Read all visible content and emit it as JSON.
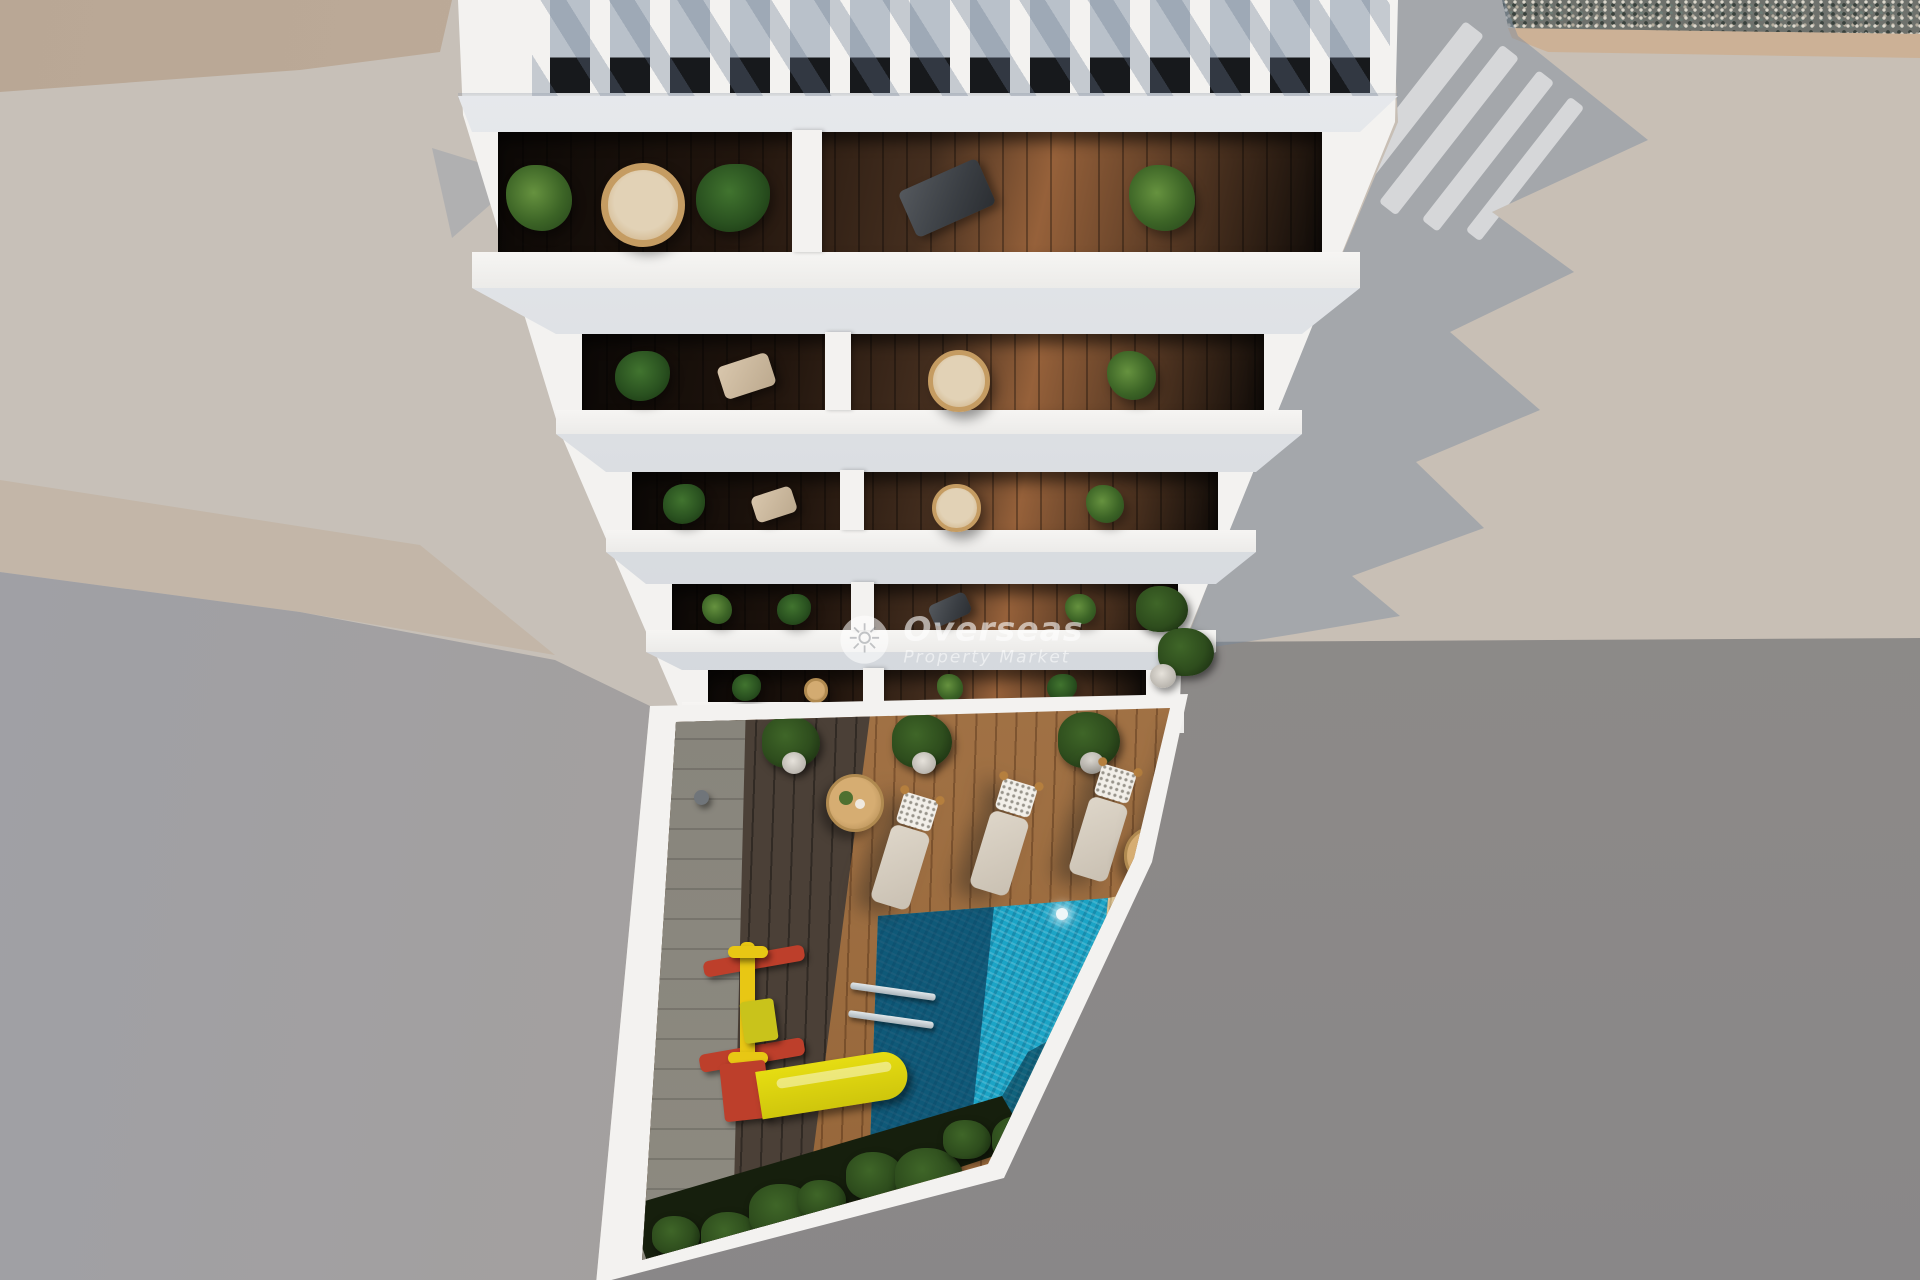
{
  "image": {
    "description": "Aerial top-down 3D architectural render of a white apartment building with rooftop pergola, five rows of stacked balconies and a courtyard with swimming pool, wooden deck, sun loungers and a children's playground",
    "width_px": 1920,
    "height_px": 1280
  },
  "watermark": {
    "brand": "Overseas",
    "tagline": "Property Market",
    "icon": "sun-icon"
  },
  "scene": {
    "building": {
      "label": "white apartment building seen from above",
      "pergola_gap_count": 14,
      "floors": [
        {
          "name": "floor-5",
          "left_unit": [
            "palm-plant",
            "hanging-chair",
            "monstera-plant"
          ],
          "right_unit": [
            "deck-chair",
            "palm-plant"
          ]
        },
        {
          "name": "floor-4",
          "left_unit": [
            "monstera-plant",
            "lounge-chair"
          ],
          "right_unit": [
            "hanging-chair",
            "palm-plant"
          ]
        },
        {
          "name": "floor-3",
          "left_unit": [
            "monstera-plant",
            "lounge-chair"
          ],
          "right_unit": [
            "hanging-chair",
            "palm-plant"
          ]
        },
        {
          "name": "floor-2",
          "left_unit": [
            "palm-plant",
            "monstera-plant"
          ],
          "right_unit": [
            "deck-chair",
            "palm-plant"
          ]
        },
        {
          "name": "floor-1",
          "left_unit": [
            "monstera-plant",
            "round-table"
          ],
          "right_unit": [
            "palm-plant",
            "monstera-plant"
          ]
        }
      ]
    },
    "courtyard": {
      "lounger_count": 4,
      "side_table_count": 2,
      "deck_pot_count": 3,
      "bottom_plant_cluster_count": 8,
      "features": [
        "swimming-pool",
        "pool-ladder",
        "pool-light",
        "wood-deck",
        "sun-loungers",
        "kids-swing-frame",
        "kids-slide",
        "potted-plants",
        "hedge-strip"
      ]
    },
    "surroundings": [
      "neighbor-flat-roof-left",
      "neighbor-roof-right",
      "gravel-strip-top",
      "street-in-shadow-bottom",
      "building-shadow-sawtooth"
    ]
  },
  "palette": {
    "base": "#c7c0b8",
    "topleft_band": "#b9a795",
    "gravel": "#6e716c",
    "gravel_edge": "#ccb196",
    "shadow_blue": "rgba(120,138,160,0.45)",
    "building_white": "#f3f2f0",
    "pergola_gap_top": "#b9c1ca",
    "pergola_gap_dark": "#17191c",
    "balcony_wood_dark": "#33241a",
    "balcony_wood_lit": "#96613a",
    "wicker": "#c59c62",
    "deck_sun": "#a6713f",
    "deck_shadow": "#4b4037",
    "sand": "#d9c193",
    "pool_bright": "#1ba4c6",
    "lounger_body": "#ded6c9",
    "lounger_pillow": "#f2efe9",
    "lounger_frame": "#b57f3e",
    "playground_red": "#bd3f2b",
    "playground_yellow": "#e8c714"
  }
}
